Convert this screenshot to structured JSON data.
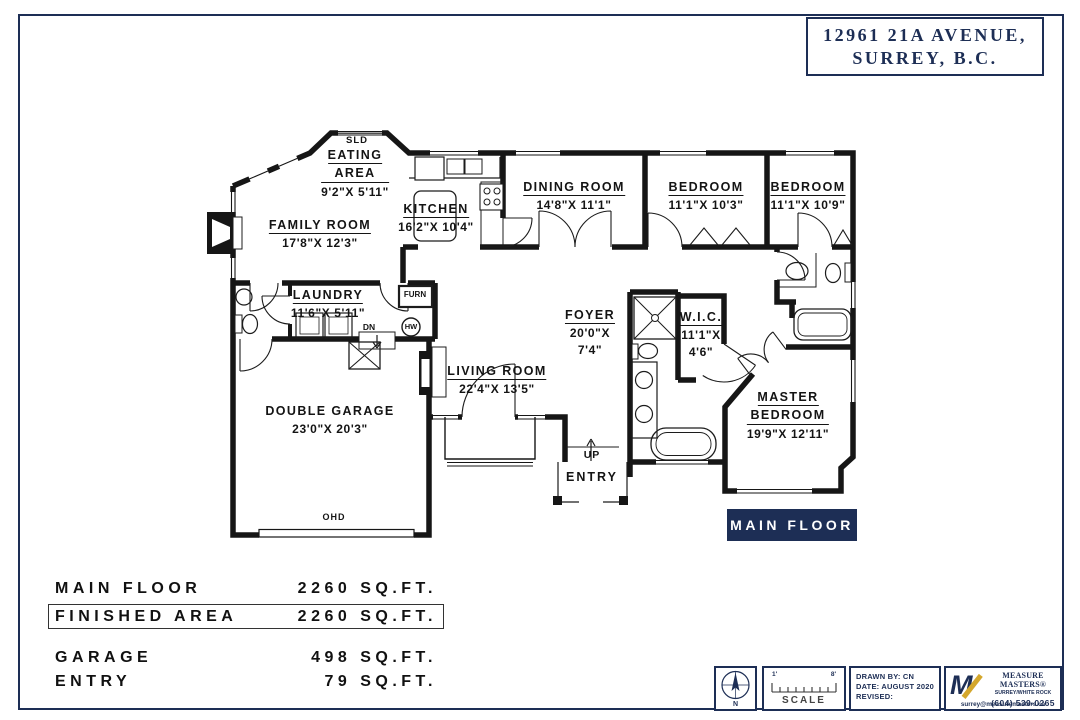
{
  "title_block": {
    "line1": "12961 21A AVENUE,",
    "line2": "SURREY, B.C."
  },
  "rooms": {
    "eating_area": {
      "name_l1": "EATING",
      "name_l2": "AREA",
      "dims": "9'2\"X 5'11\""
    },
    "family_room": {
      "name": "FAMILY ROOM",
      "dims": "17'8\"X 12'3\""
    },
    "kitchen": {
      "name": "KITCHEN",
      "dims": "16'2\"X 10'4\""
    },
    "dining_room": {
      "name": "DINING ROOM",
      "dims": "14'8\"X 11'1\""
    },
    "bedroom_1": {
      "name": "BEDROOM",
      "dims": "11'1\"X 10'3\""
    },
    "bedroom_2": {
      "name": "BEDROOM",
      "dims": "11'1\"X 10'9\""
    },
    "laundry": {
      "name": "LAUNDRY",
      "dims": "11'6\"X 5'11\""
    },
    "foyer": {
      "name": "FOYER",
      "dims_l1": "20'0\"X",
      "dims_l2": "7'4\""
    },
    "wic": {
      "name": "W.I.C.",
      "dims_l1": "11'1\"X",
      "dims_l2": "4'6\""
    },
    "living_room": {
      "name": "LIVING ROOM",
      "dims": "22'4\"X 13'5\""
    },
    "double_garage": {
      "name": "DOUBLE GARAGE",
      "dims": "23'0\"X 20'3\""
    },
    "master_bedroom": {
      "name_l1": "MASTER",
      "name_l2": "BEDROOM",
      "dims": "19'9\"X 12'11\""
    }
  },
  "plan_marks": {
    "sld": "SLD",
    "furn": "FURN",
    "hw": "HW",
    "dn": "DN",
    "up": "UP",
    "entry": "ENTRY",
    "ohd": "OHD"
  },
  "floor_badge": "MAIN FLOOR",
  "area_summary": {
    "rows": [
      {
        "label": "MAIN FLOOR",
        "value": "2260 SQ.FT."
      },
      {
        "label": "FINISHED AREA",
        "value": "2260 SQ.FT."
      },
      {
        "label": "GARAGE",
        "value": "498 SQ.FT."
      },
      {
        "label": "ENTRY",
        "value": "79 SQ.FT."
      }
    ]
  },
  "footer": {
    "compass": "N",
    "scale": {
      "left_tick": "1'",
      "right_tick": "8'",
      "label": "SCALE"
    },
    "drawing_info": {
      "line1": "DRAWN BY: CN",
      "line2": "DATE: AUGUST 2020",
      "line3": "REVISED:"
    },
    "logo": {
      "name": "MEASURE MASTERS®",
      "region": "SURREY/WHITE ROCK",
      "phone": "(604) 539-0265",
      "email": "surrey@measuremasters.ca"
    }
  },
  "colors": {
    "navy": "#1d2e55",
    "line": "#161616",
    "gold": "#d4a72c"
  }
}
